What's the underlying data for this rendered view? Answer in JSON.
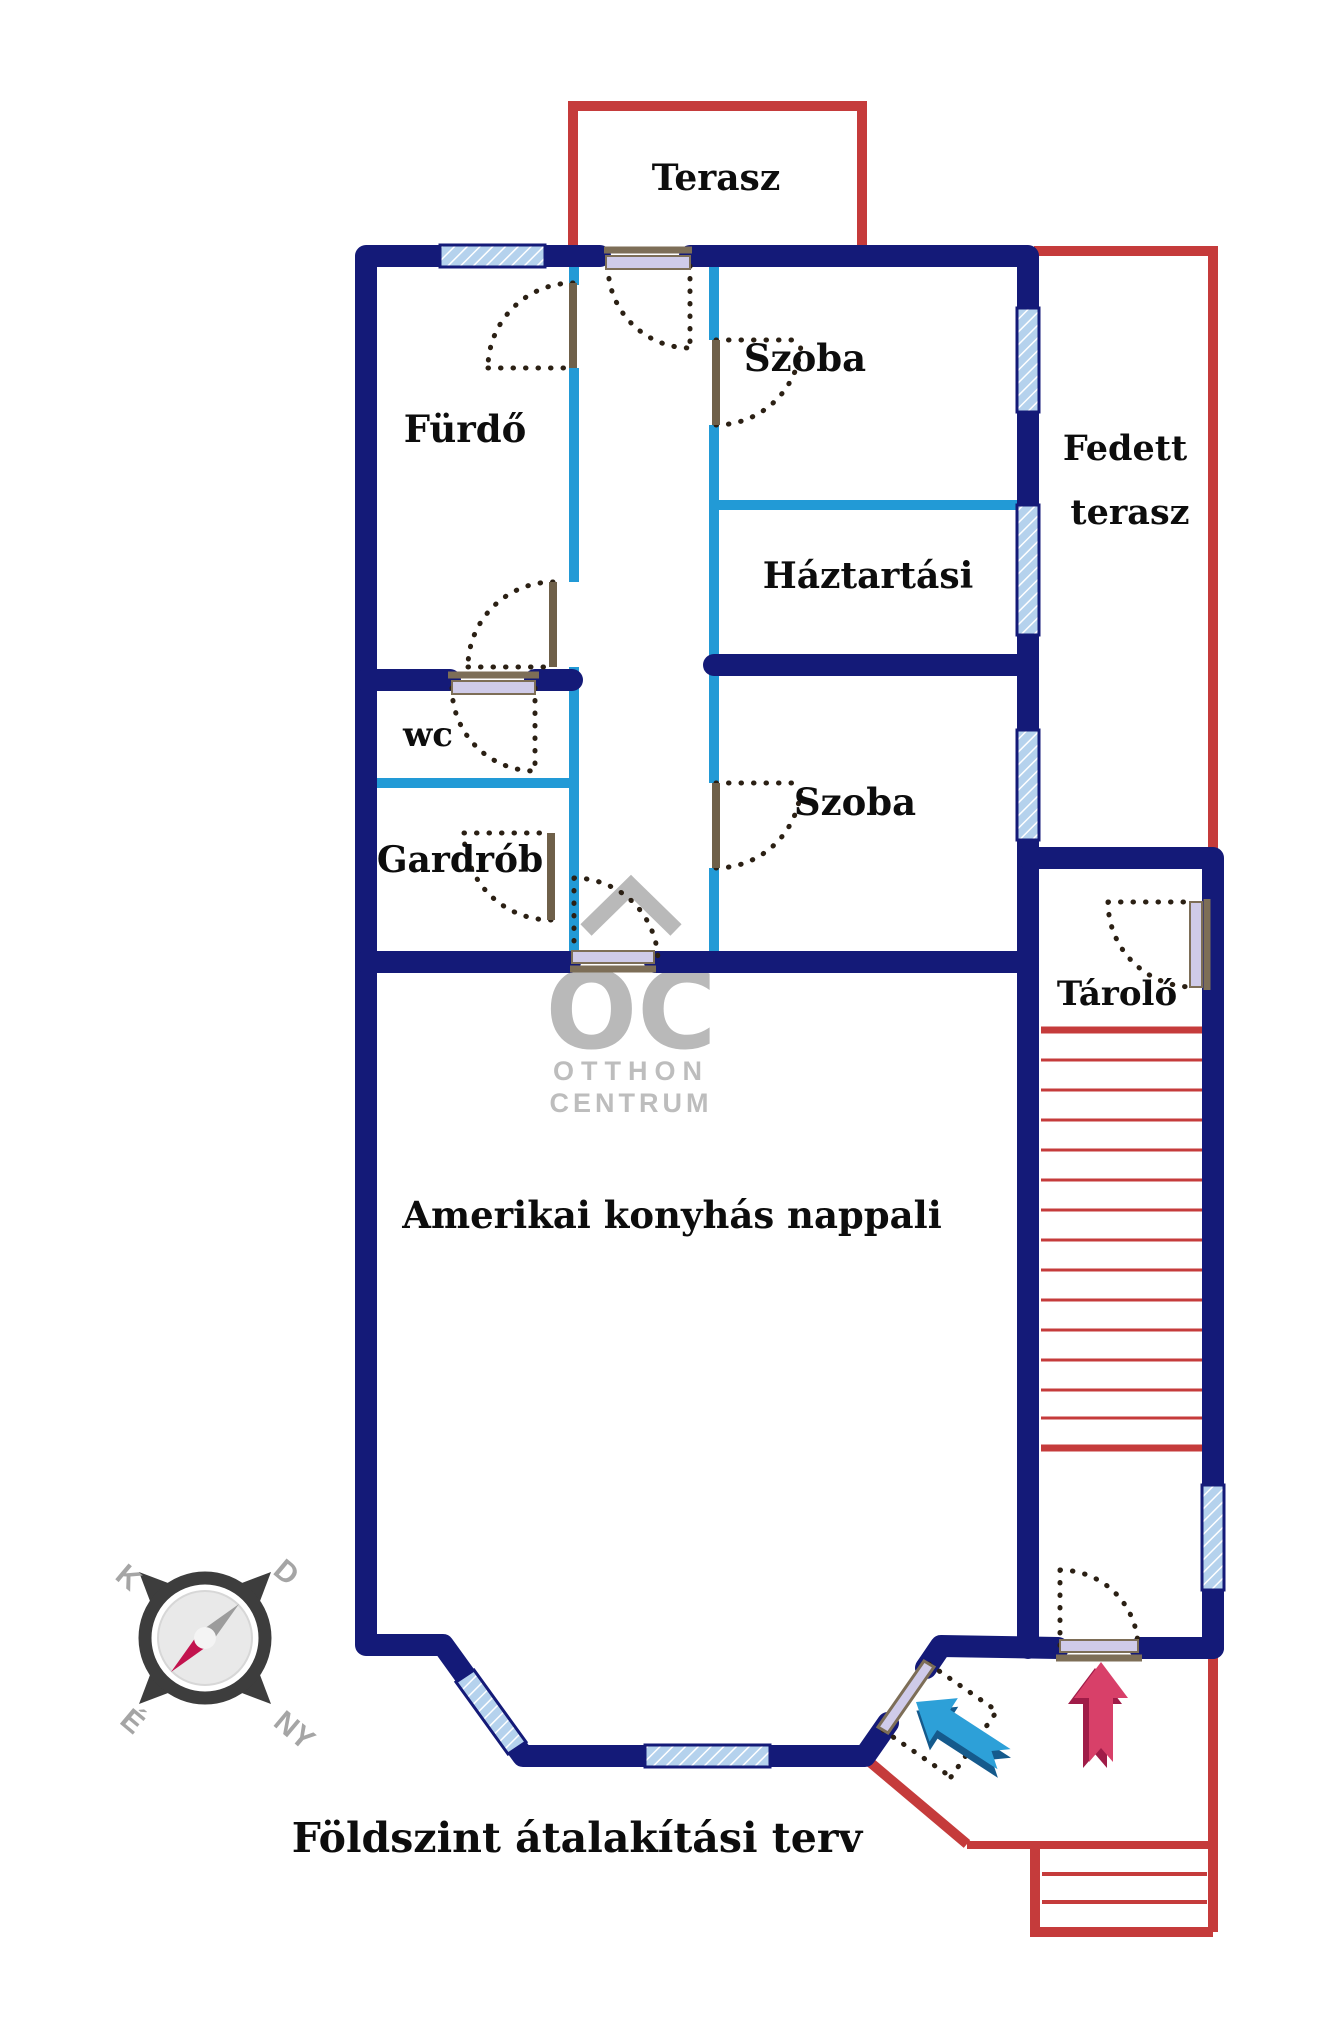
{
  "plan": {
    "title": "Földszint átalakítási terv",
    "rooms": {
      "terasz": "Terasz",
      "furdo": "Fürdő",
      "szoba1": "Szoba",
      "haztartasi": "Háztartási",
      "fedett_line1": "Fedett",
      "fedett_line2": "terasz",
      "wc": "wc",
      "gardrob": "Gardrób",
      "szoba2": "Szoba",
      "tarolo": "Tároló",
      "nappali": "Amerikai konyhás nappali"
    },
    "logo": {
      "monogram": "OC",
      "line1": "OTTHON",
      "line2": "CENTRUM"
    },
    "compass": {
      "east": "K",
      "south": "D",
      "north": "É",
      "west": "NY"
    },
    "colors": {
      "wall_navy": "#141a78",
      "partition_cyan": "#229ad6",
      "terrace_red": "#c53b3b",
      "window_fill": "#b5d2ed",
      "door_frame_brown": "#7d6e57",
      "door_leaf_lavender": "#cfcbe9",
      "swing_dots": "#2b2014",
      "logo_grey": "#b9b9b9",
      "arrow_blue": "#2da0d8",
      "arrow_blue_dark": "#155a8c",
      "arrow_red": "#d84069",
      "arrow_red_dark": "#a01c48"
    }
  }
}
